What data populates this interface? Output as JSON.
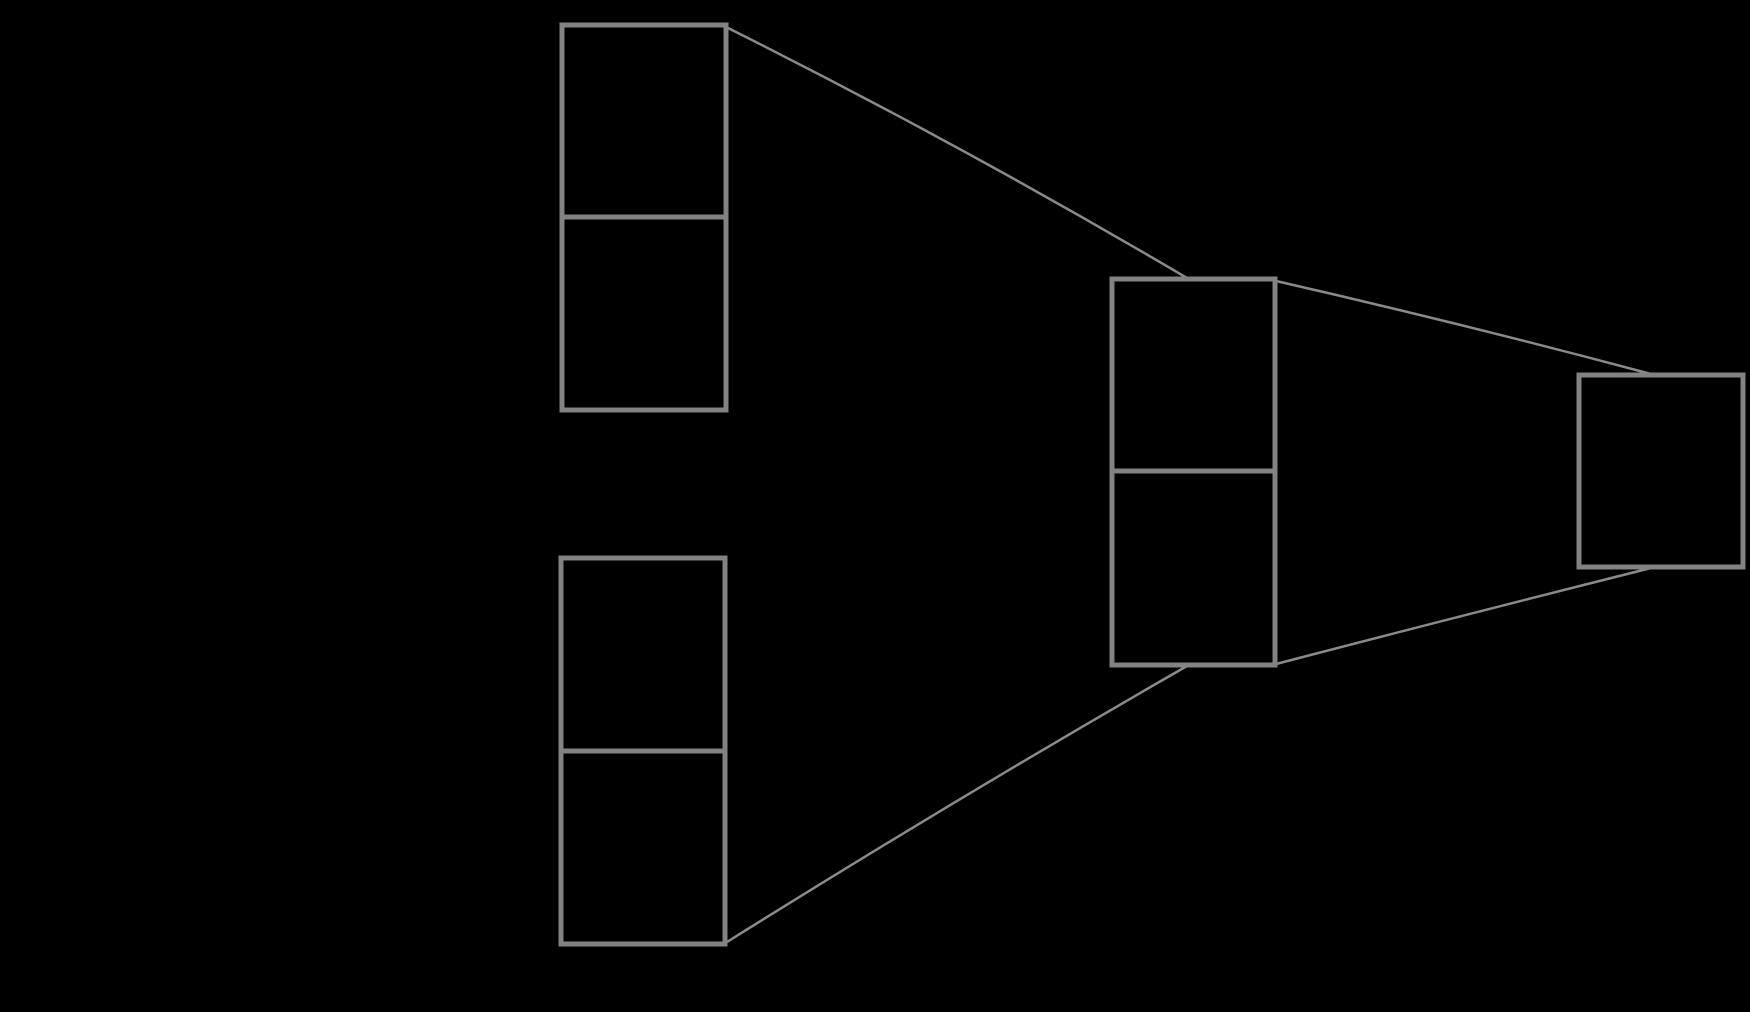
{
  "canvas": {
    "width": 1750,
    "height": 1012,
    "background_color": "#000000"
  },
  "diagram": {
    "description": "merge-tree-of-empty-record-nodes",
    "style": {
      "node_stroke_color": "#828282",
      "node_fill": "none",
      "node_stroke_width": 5,
      "edge_stroke_color": "#8a8a8a",
      "edge_stroke_width": 2.5,
      "arrowheads": "none",
      "cell_text": ""
    },
    "nodes": [
      {
        "name": "record-node-top-left",
        "x": 562,
        "y": 25,
        "w": 164,
        "h": 385,
        "cells": 2,
        "dividers_y": [
          217
        ]
      },
      {
        "name": "record-node-bottom-left",
        "x": 561,
        "y": 558,
        "w": 164,
        "h": 386,
        "cells": 2,
        "dividers_y": [
          751
        ]
      },
      {
        "name": "record-node-middle",
        "x": 1112,
        "y": 279,
        "w": 163,
        "h": 386,
        "cells": 2,
        "dividers_y": [
          471
        ]
      },
      {
        "name": "record-node-right",
        "x": 1579,
        "y": 375,
        "w": 164,
        "h": 192,
        "cells": 1,
        "dividers_y": []
      }
    ],
    "edges": [
      {
        "name": "edge-topleft-node-to-middle-node",
        "from": [
          728,
          28
        ],
        "ctrl": [
          958,
          143
        ],
        "to": [
          1187,
          278
        ]
      },
      {
        "name": "edge-bottomleft-node-to-middle-node",
        "from": [
          727,
          942
        ],
        "ctrl": [
          957,
          798
        ],
        "to": [
          1187,
          666
        ]
      },
      {
        "name": "edge-middle-node-to-right-node-upper",
        "from": [
          1276,
          281
        ],
        "ctrl": [
          1464,
          324
        ],
        "to": [
          1651,
          374
        ]
      },
      {
        "name": "edge-middle-node-to-right-node-lower",
        "from": [
          1276,
          664
        ],
        "ctrl": [
          1464,
          615
        ],
        "to": [
          1651,
          568
        ]
      }
    ]
  }
}
